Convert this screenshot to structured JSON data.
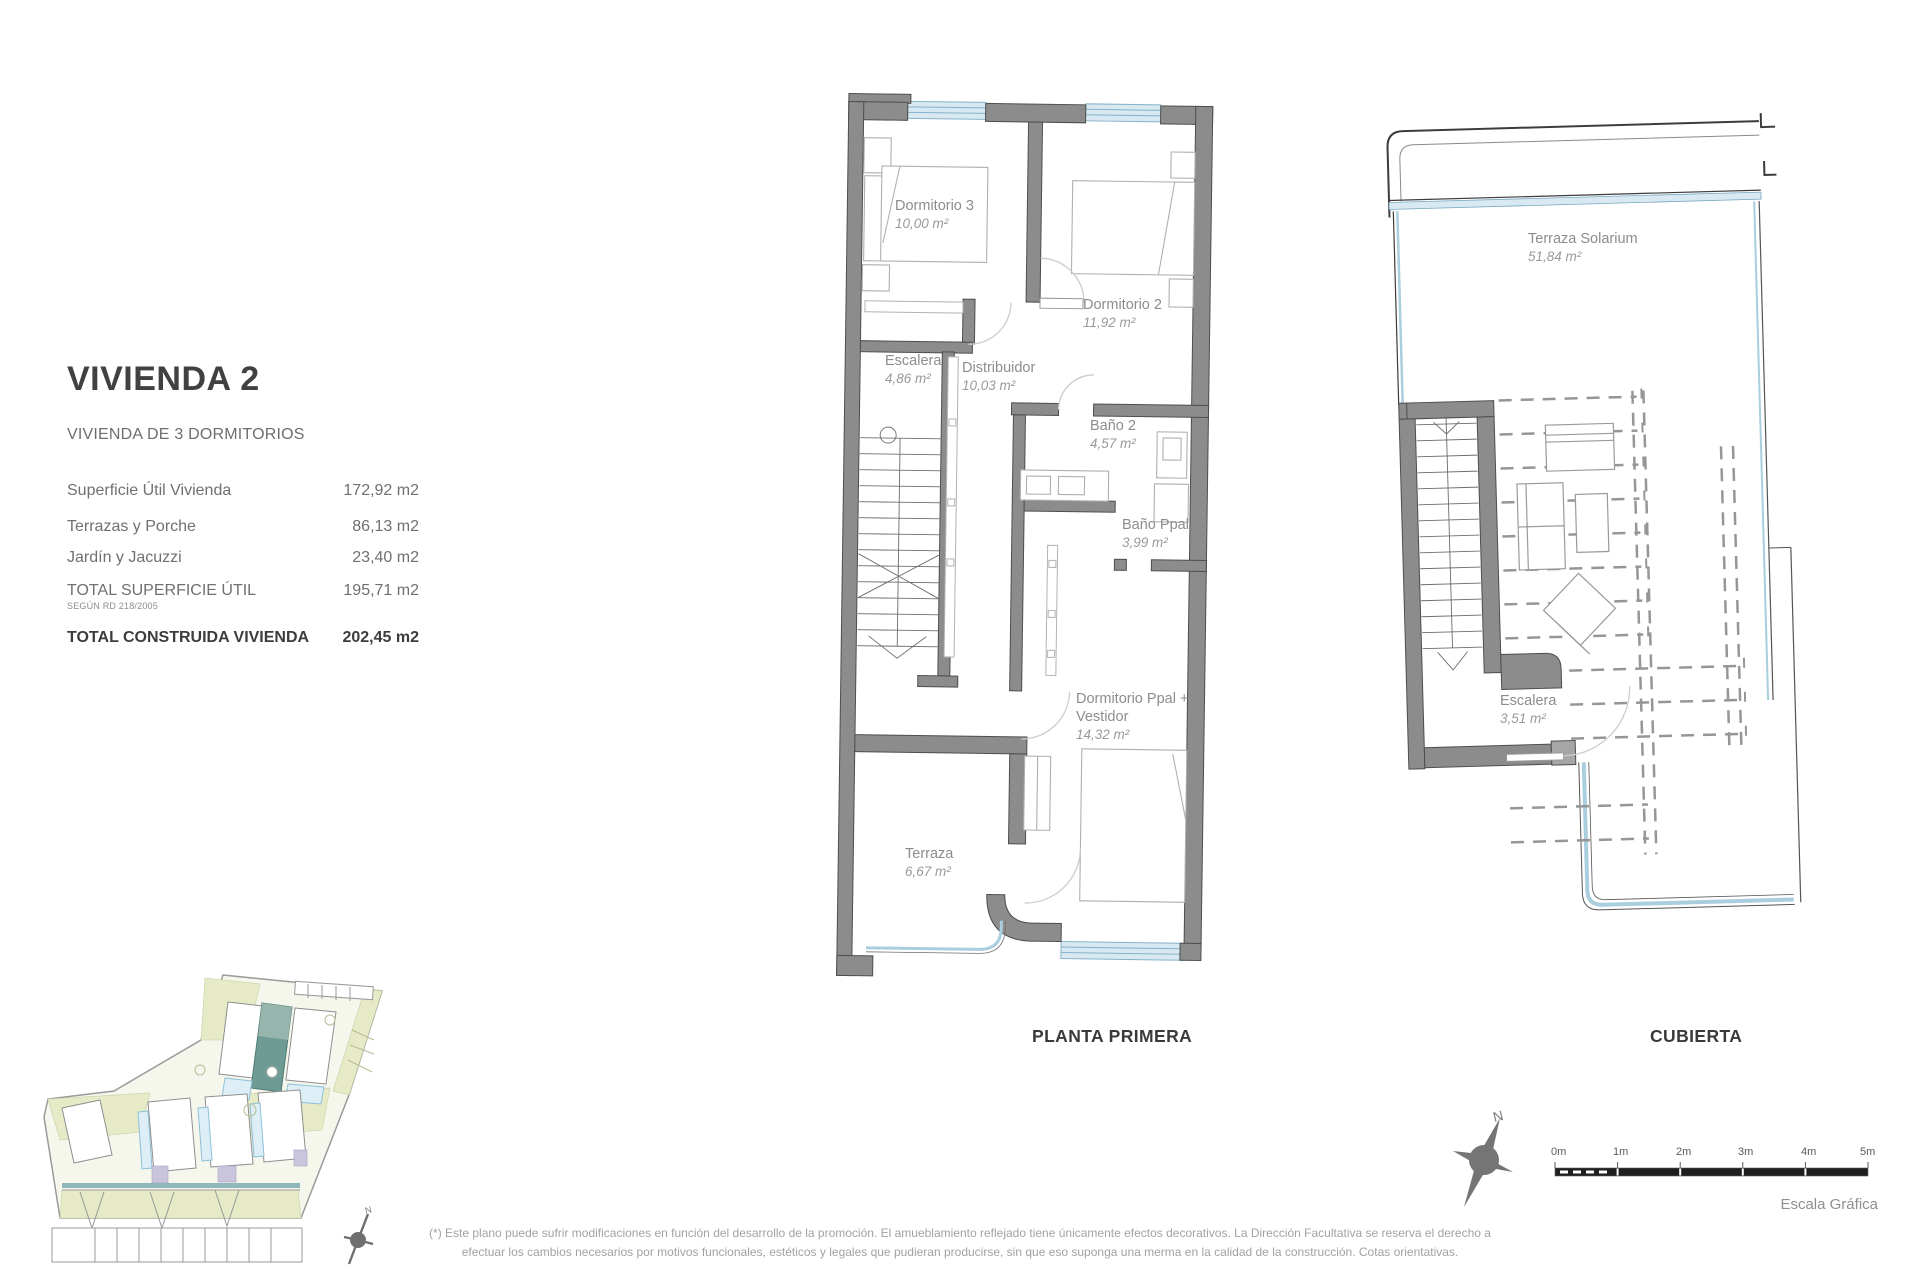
{
  "info_panel": {
    "title": "VIVIENDA 2",
    "subtitle": "VIVIENDA DE 3 DORMITORIOS",
    "rows": [
      {
        "label": "Superficie Útil Vivienda",
        "value": "172,92 m2"
      },
      {
        "label": "Terrazas y Porche",
        "value": "86,13 m2"
      },
      {
        "label": "Jardín y Jacuzzi",
        "value": "23,40 m2"
      },
      {
        "label": "TOTAL SUPERFICIE ÚTIL",
        "note": "SEGÚN RD 218/2005",
        "value": "195,71 m2"
      },
      {
        "label": "TOTAL CONSTRUIDA VIVIENDA",
        "value": "202,45 m2"
      }
    ]
  },
  "plans": {
    "planta_primera": {
      "caption": "PLANTA PRIMERA",
      "rooms": {
        "dormitorio3": {
          "name": "Dormitorio 3",
          "area": "10,00 m²"
        },
        "dormitorio2": {
          "name": "Dormitorio 2",
          "area": "11,92 m²"
        },
        "escalera": {
          "name": "Escalera",
          "area": "4,86 m²"
        },
        "distribuidor": {
          "name": "Distribuidor",
          "area": "10,03 m²"
        },
        "banio2": {
          "name": "Baño 2",
          "area": "4,57 m²"
        },
        "banioppal": {
          "name": "Baño Ppal",
          "area": "3,99 m²"
        },
        "dormppal": {
          "line1": "Dormitorio Ppal +",
          "line2": "Vestidor",
          "area": "14,32 m²"
        },
        "terraza": {
          "name": "Terraza",
          "area": "6,67 m²"
        }
      }
    },
    "cubierta": {
      "caption": "CUBIERTA",
      "rooms": {
        "solarium": {
          "name": "Terraza Solarium",
          "area": "51,84 m²"
        },
        "escalera": {
          "name": "Escalera",
          "area": "3,51 m²"
        }
      }
    }
  },
  "compass": {
    "north_label": "N"
  },
  "minimap_compass": {
    "north_label": "N"
  },
  "scale_bar": {
    "ticks": [
      "0m",
      "1m",
      "2m",
      "3m",
      "4m",
      "5m"
    ],
    "caption": "Escala Gráfica"
  },
  "footnote": {
    "line1": "(*) Este plano puede sufrir modificaciones en función del desarrollo de la promoción. El amueblamiento reflejado tiene únicamente efectos decorativos. La Dirección Facultativa se reserva el derecho a",
    "line2": "efectuar los cambios necesarios por motivos funcionales, estéticos y legales que pudieran producirse, sin que eso suponga una merma en la calidad de la construcción. Cotas orientativas."
  },
  "colors": {
    "wall_gray": "#8c8c8c",
    "window_blue": "#d9e9f2",
    "glass_blue": "#a9cede",
    "highlight_teal": "#6e9b93",
    "site_olive": "#e6eac6",
    "accent_purple": "#c9c5dc"
  }
}
